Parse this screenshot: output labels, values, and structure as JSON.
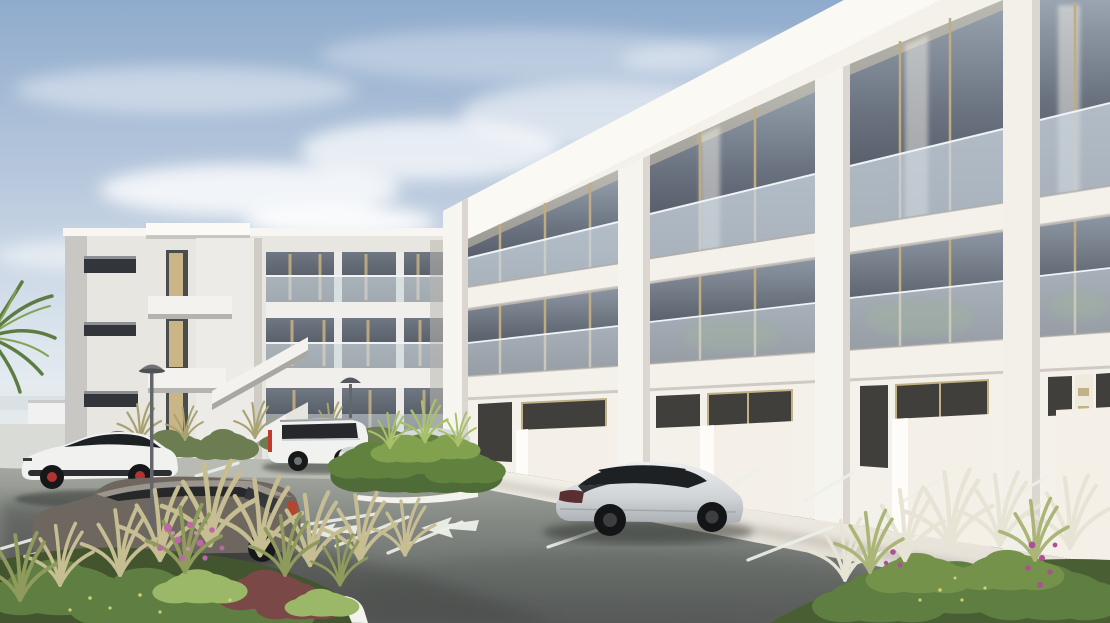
{
  "scene": {
    "type": "architectural-exterior-rendering",
    "description": "Photorealistic daytime rendering of a modern white three-storey apartment complex with gold-framed glass facades and frosted glass balconies, seen from its landscaped parking lot with parked cars, white stall markings, pavement arrows, street lamps, shrubs, grasses, pink flowers and palm fronds",
    "objects": [
      "sky with soft clouds",
      "left apartment block with external staircase tower",
      "right apartment block with glass balconies",
      "parking lot asphalt",
      "white stall markings",
      "two white pavement direction arrows",
      "white SUV with red brake calipers",
      "dark grey estate car",
      "white full-size SUV with red tail lamp",
      "silver SUV behind shrub island",
      "silver sedan parked nose-in",
      "centre shrub island with white curb",
      "foreground planting bed with pink flowers and burgundy shrub",
      "right planting bed with grasses and magenta flowers",
      "palm fronds at left edge",
      "street lamps",
      "louvred service door"
    ]
  },
  "colors": {
    "sky_top": "#8fabcc",
    "sky_horizon": "#eef1f3",
    "cloud_white": "#ffffff",
    "building_white": "#f4f1eb",
    "fascia_white": "#faf8f3",
    "left_building": "#e8e6e1",
    "glass_dark": "#4b5058",
    "balustrade_glass": "#ccd7e0",
    "frame_tan": "#bfad81",
    "marking_white": "#edefe9",
    "sidewalk": "#efece4",
    "curb_white": "#f3f2ed",
    "foliage_green": "#5f7e42",
    "foliage_light": "#8fae5e",
    "grass_tan": "#c6bd92",
    "flower_pink": "#bd67a6",
    "flower_yellow": "#d8d977",
    "shrub_burgundy": "#7b4848",
    "car_white": "#f1f2f0",
    "car_silver": "#d7dadc",
    "car_dark_grey": "#6e675f",
    "glass_black": "#1e2124",
    "tail_red": "#c03a2e",
    "lamp_grey": "#63666a"
  }
}
